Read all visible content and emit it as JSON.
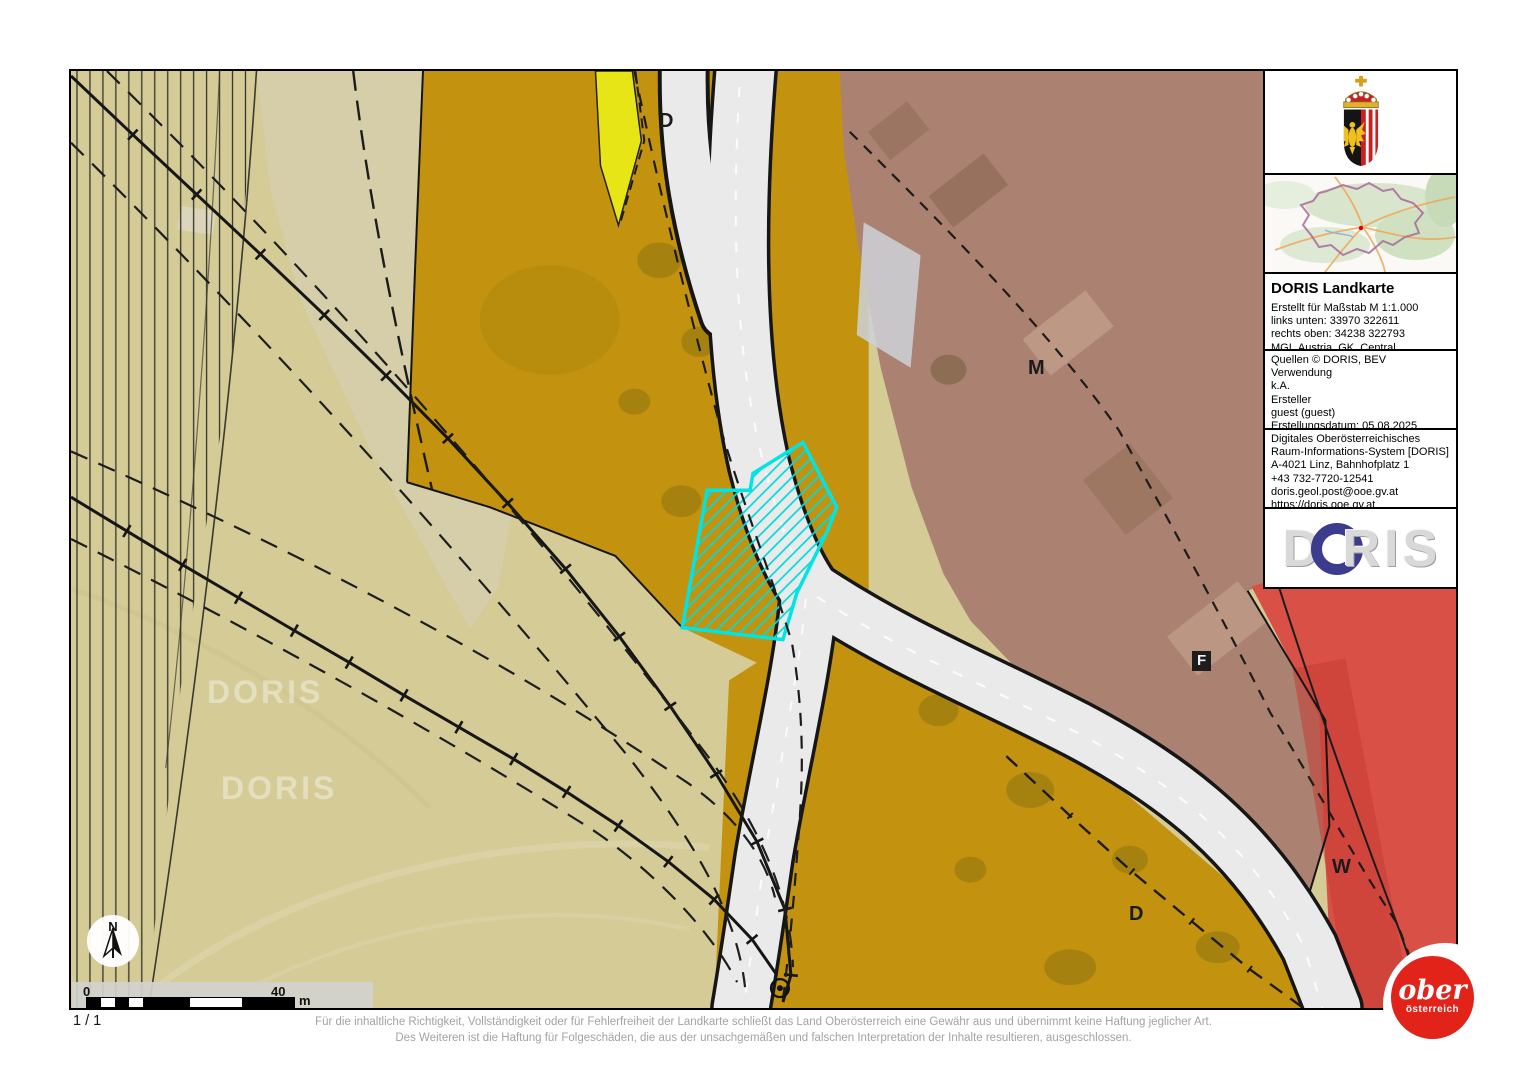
{
  "page": {
    "number": "1 / 1",
    "disclaimer_line1": "Für die inhaltliche Richtigkeit, Vollständigkeit oder für Fehlerfreiheit der Landkarte schließt das Land Oberösterreich eine Gewähr aus und übernimmt keine Haftung jeglicher Art.",
    "disclaimer_line2": "Des Weiteren ist die Haftung für Folgeschäden, die aus der unsachgemäßen und falschen Interpretation der Inhalte resultieren, ausgeschlossen."
  },
  "map": {
    "labels": [
      {
        "text": "D"
      },
      {
        "text": "M"
      },
      {
        "text": "F"
      },
      {
        "text": "W"
      },
      {
        "text": "D"
      }
    ],
    "watermark": "DORIS",
    "north_label": "N",
    "scalebar": {
      "start": "0",
      "end": "40",
      "unit": "m"
    },
    "selection_color": "#00e4e4",
    "zone_colors": {
      "khaki": "#d4cb96",
      "ochre": "#c3930f",
      "brown": "#ab8271",
      "red": "#d95046",
      "yellow": "#e7e515",
      "road": "#eaeaea"
    }
  },
  "panel": {
    "title": "DORIS Landkarte",
    "meta_lines": [
      "Erstellt für Maßstab M 1:1.000",
      "links unten: 33970 322611",
      "rechts oben: 34238 322793",
      "MGI_Austria_GK_Central"
    ],
    "source_lines": [
      "Quellen © DORIS, BEV",
      "Verwendung",
      "k.A.",
      "Ersteller",
      "guest (guest)",
      "Erstellungsdatum: 05.08.2025"
    ],
    "contact_lines": [
      "Digitales Oberösterreichisches",
      "Raum-Informations-System [DORIS]",
      "A-4021 Linz, Bahnhofplatz 1",
      "+43 732-7720-12541",
      "doris.geol.post@ooe.gv.at",
      "https://doris.ooe.gv.at"
    ],
    "logo": {
      "d": "D",
      "ris": "RIS"
    }
  },
  "footer_logo": {
    "line1": "ober",
    "line2": "österreich",
    "color": "#e2231a"
  }
}
